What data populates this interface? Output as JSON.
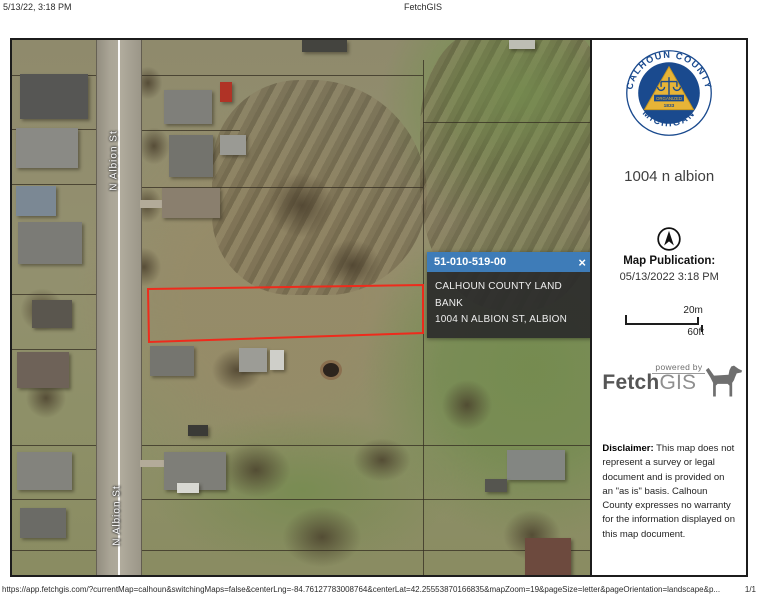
{
  "header": {
    "datetime": "5/13/22, 3:18 PM",
    "title": "FetchGIS"
  },
  "footer": {
    "url": "https://app.fetchgis.com/?currentMap=calhoun&switchingMaps=false&centerLng=-84.76127783008764&centerLat=42.25553870166835&mapZoom=19&pageSize=letter&pageOrientation=landscape&p...",
    "page_indicator": "1/1"
  },
  "map": {
    "street_label": "N Albion St",
    "highlight_color": "#ee2b1c",
    "popup": {
      "parcel_id": "51-010-519-00",
      "close_icon": "×",
      "owner": "CALHOUN COUNTY LAND BANK",
      "address": "1004 N ALBION ST, ALBION",
      "header_color": "#3e7cb8"
    }
  },
  "sidebar": {
    "seal": {
      "arc_top": "CALHOUN  COUNTY",
      "arc_bottom": "MICHIGAN",
      "banner": "ORGANIZED",
      "year": "1833",
      "blue": "#1a4a8e",
      "gold": "#e7b437"
    },
    "title": "1004 n albion",
    "publication": {
      "label": "Map Publication:",
      "datetime": "05/13/2022 3:18 PM"
    },
    "scale": {
      "metric": "20m",
      "imperial": "60ft"
    },
    "branding": {
      "powered_by": "powered by",
      "name_bold": "Fetch",
      "name_light": "GIS"
    },
    "disclaimer": {
      "label": "Disclaimer:",
      "text": " This map does not represent a survey or legal document and is provided on an \"as is\" basis. Calhoun County expresses no warranty for the information displayed on this map document."
    }
  }
}
